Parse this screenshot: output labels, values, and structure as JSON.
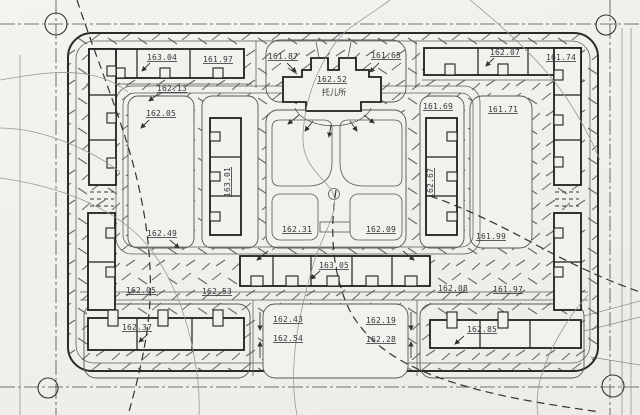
{
  "drawing": {
    "kind_note": "scanned residential block site plan",
    "paper_color": "#f2f1ed",
    "ink_color": "#1f1f1f",
    "thin_line_color": "#5a5a5a",
    "contour_color": "#979797"
  },
  "labels": [
    "163.04",
    "161.97",
    "162.13",
    "162.05",
    "161.87",
    "161.65",
    "162.52",
    "托儿所",
    "162.07",
    "161.74",
    "161.69",
    "161.71",
    "163.01",
    "162.67",
    "162.49",
    "162.31",
    "162.09",
    "161.99",
    "162.05",
    "162.53",
    "162.08",
    "161.97",
    "163.05",
    "162.37",
    "162.43",
    "162.54",
    "162.19",
    "162.28",
    "162.85"
  ]
}
